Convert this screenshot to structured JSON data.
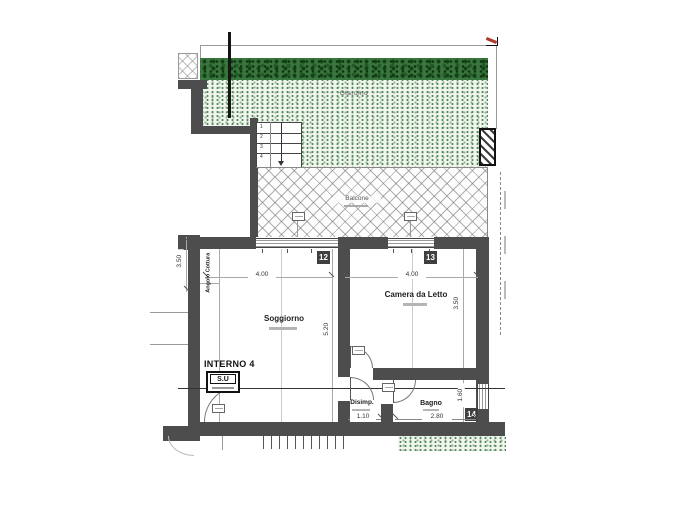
{
  "plan": {
    "outdoor": {
      "garden_label": "Giardino",
      "balcony_label": "Balcone"
    },
    "rooms": {
      "soggiorno": "Soggiorno",
      "camera": "Camera da Letto",
      "disimpegno": "Disimp.",
      "bagno": "Bagno",
      "angolo_cottura": "Angolo Cottura"
    },
    "unit": {
      "name": "INTERNO 4",
      "su": "S.U"
    },
    "openings": {
      "w12": "12",
      "w13": "13",
      "w14": "14"
    },
    "stairs": [
      "1",
      "2",
      "3",
      "4"
    ],
    "dims": {
      "left_height": "3.50",
      "soggiorno_width": "4.00",
      "camera_width": "4.00",
      "soggiorno_height": "5.20",
      "camera_height": "3.50",
      "bagno_height": "1.60",
      "disimpegno_width": "1.10",
      "bagno_width": "2.80"
    },
    "colors": {
      "wall": "#4d4d4d",
      "hedge": "#2e6b33",
      "garden_dots": "#55885a",
      "marker_red": "#b03a2e"
    }
  }
}
